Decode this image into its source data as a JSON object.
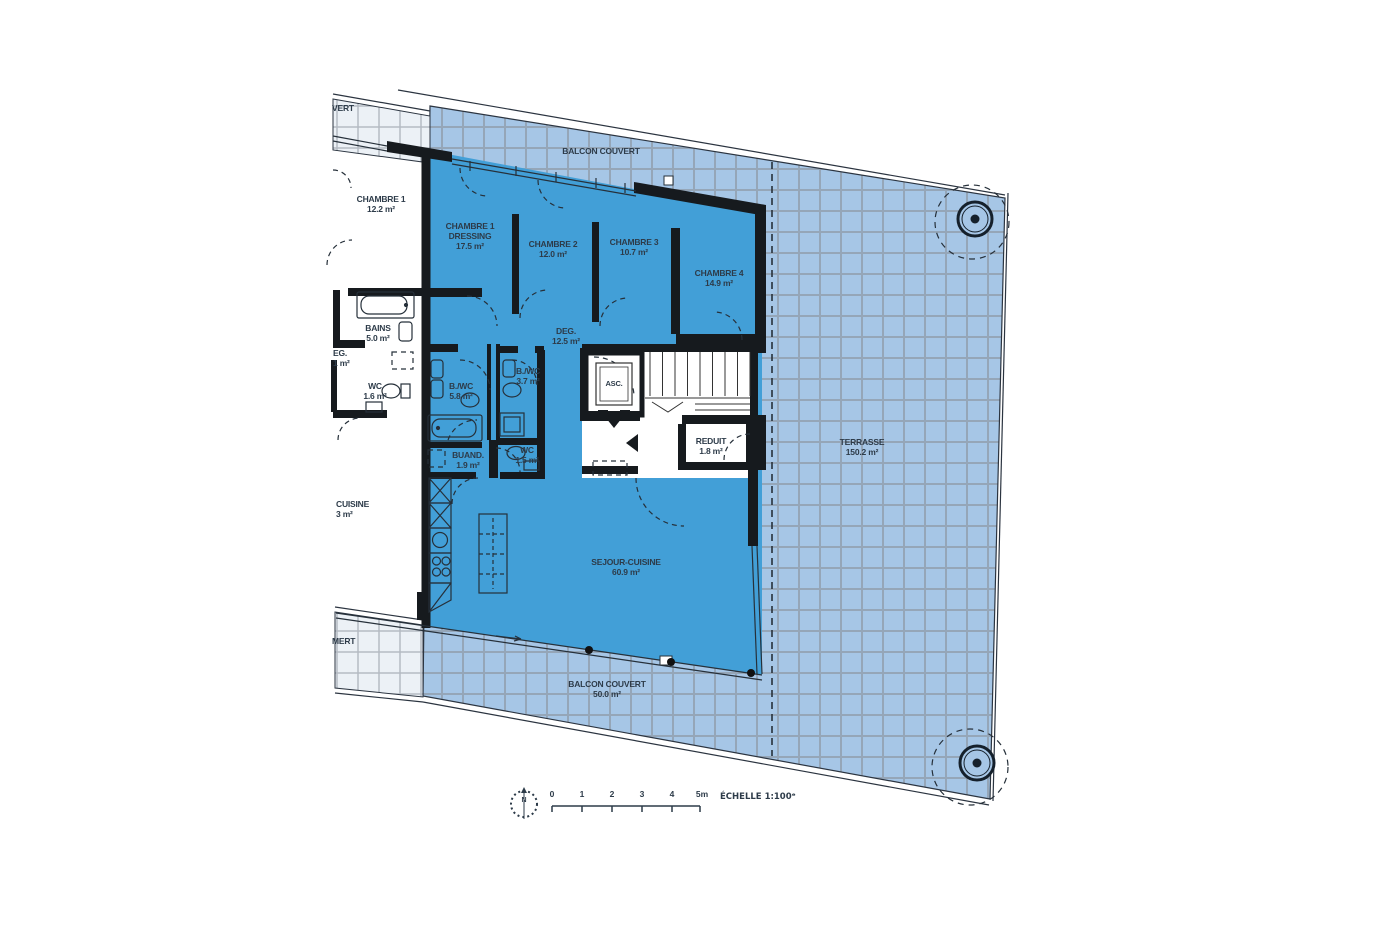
{
  "outdoor": {
    "balcon_top": {
      "name": "BALCON COUVERT"
    },
    "balcon_bottom": {
      "name": "BALCON COUVERT",
      "area": "50.0 m²"
    },
    "terrasse": {
      "name": "TERRASSE",
      "area": "150.2 m²"
    }
  },
  "labels": {
    "chambre1_voisin": {
      "name": "CHAMBRE 1",
      "area": "12.2 m²"
    },
    "chambre1_dressing": {
      "name": "CHAMBRE 1",
      "name2": "DRESSING",
      "area": "17.5 m²"
    },
    "chambre2": {
      "name": "CHAMBRE 2",
      "area": "12.0 m²"
    },
    "chambre3": {
      "name": "CHAMBRE 3",
      "area": "10.7 m²"
    },
    "chambre4": {
      "name": "CHAMBRE 4",
      "area": "14.9 m²"
    },
    "bains": {
      "name": "BAINS",
      "area": "5.0 m²"
    },
    "deg_voisin": {
      "name": "EG.",
      "area": "1 m²"
    },
    "wc_voisin": {
      "name": "WC",
      "area": "1.6 m²"
    },
    "bwc_58": {
      "name": "B./WC",
      "area": "5.8 m²"
    },
    "bwc_37": {
      "name": "B./WC",
      "area": "3.7 m²"
    },
    "deg": {
      "name": "DEG.",
      "area": "12.5 m²"
    },
    "asc": {
      "name": "ASC."
    },
    "reduit": {
      "name": "REDUIT",
      "area": "1.8 m²"
    },
    "wc_15": {
      "name": "WC",
      "area": "1.5 m²"
    },
    "buand": {
      "name": "BUAND.",
      "area": "1.9 m²"
    },
    "cuisine_voisin": {
      "name": "CUISINE",
      "area": "3 m²"
    },
    "sejour": {
      "name": "SEJOUR-CUISINE",
      "area": "60.9 m²"
    },
    "vert_top": {
      "name": "VERT"
    },
    "vert_bottom": {
      "name": "MERT"
    }
  },
  "scale_bar": {
    "north": "N",
    "ticks": [
      "0",
      "1",
      "2",
      "3",
      "4",
      "5m"
    ],
    "echelle": "ÉCHELLE 1:100ᵉ"
  },
  "colors": {
    "room_fill": "#429FD7",
    "outdoor_fill": "#A6C6E6",
    "neighbor_outdoor_fill": "#ECF1F6",
    "wall": "#161A1E",
    "text": "#2D3B49"
  }
}
